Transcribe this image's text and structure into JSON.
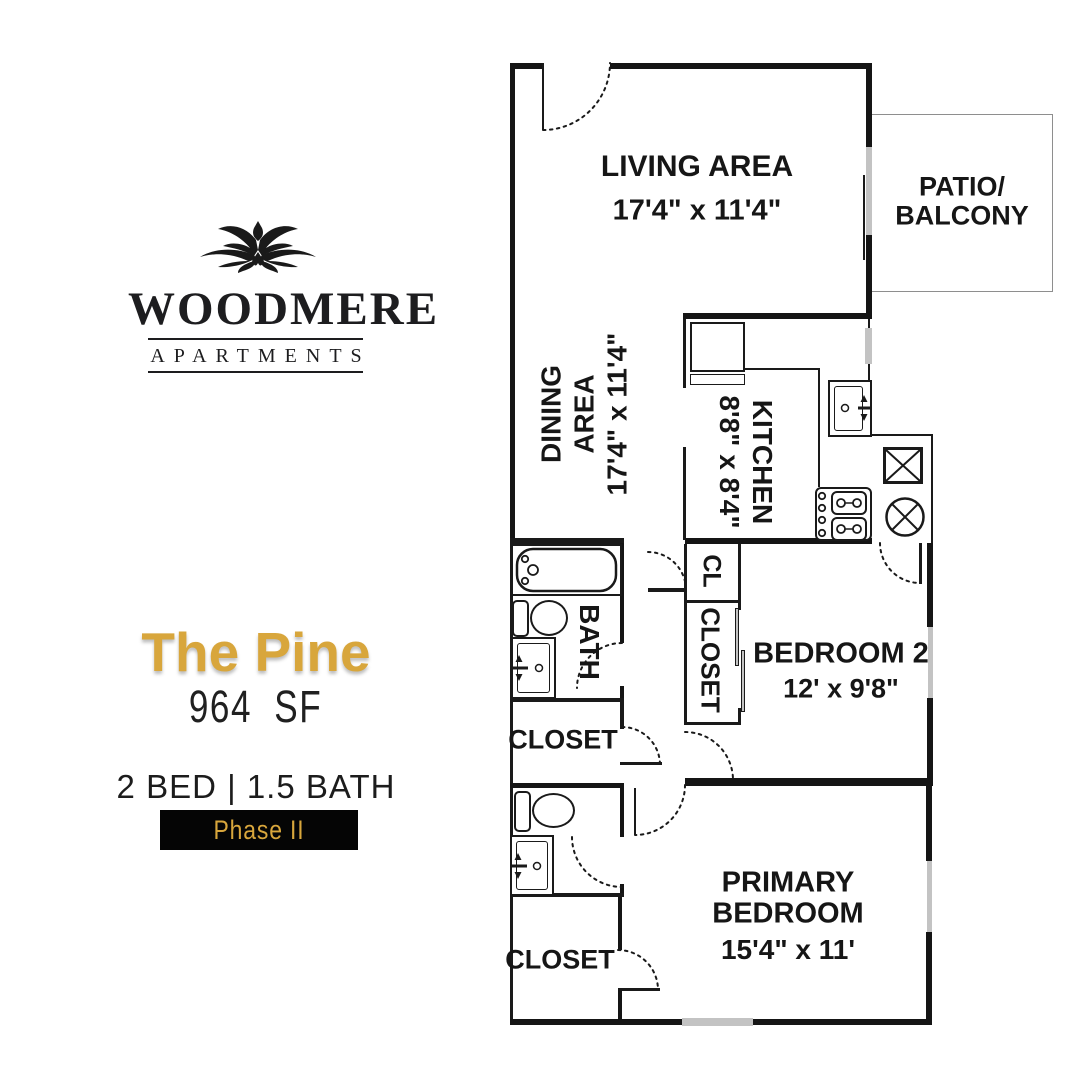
{
  "brand": {
    "name": "WOODMERE",
    "subtitle": "APARTMENTS"
  },
  "unit": {
    "name": "The Pine",
    "size": "964 SF",
    "beds_baths": "2 BED | 1.5 BATH",
    "phase": "Phase II"
  },
  "colors": {
    "gold": "#D8A63C",
    "ink": "#151515",
    "window_gray": "#c3c3c3"
  },
  "rooms": {
    "living": {
      "name": "LIVING AREA",
      "dims": "17'4\" x 11'4\""
    },
    "patio": {
      "line1": "PATIO/",
      "line2": "BALCONY"
    },
    "dining": {
      "line1": "DINING",
      "line2": "AREA",
      "dims": "17'4\" x 11'4\""
    },
    "kitchen": {
      "name": "KITCHEN",
      "dims": "8'8\" x 8'4\""
    },
    "bath": {
      "name": "BATH"
    },
    "cl": {
      "name": "CL"
    },
    "closet_bedroom2": {
      "name": "CLOSET"
    },
    "closet_hall": {
      "name": "CLOSET"
    },
    "closet_primary": {
      "name": "CLOSET"
    },
    "bedroom2": {
      "name": "BEDROOM 2",
      "dims": "12' x 9'8\""
    },
    "primary": {
      "line1": "PRIMARY",
      "line2": "BEDROOM",
      "dims": "15'4\" x 11'"
    }
  }
}
